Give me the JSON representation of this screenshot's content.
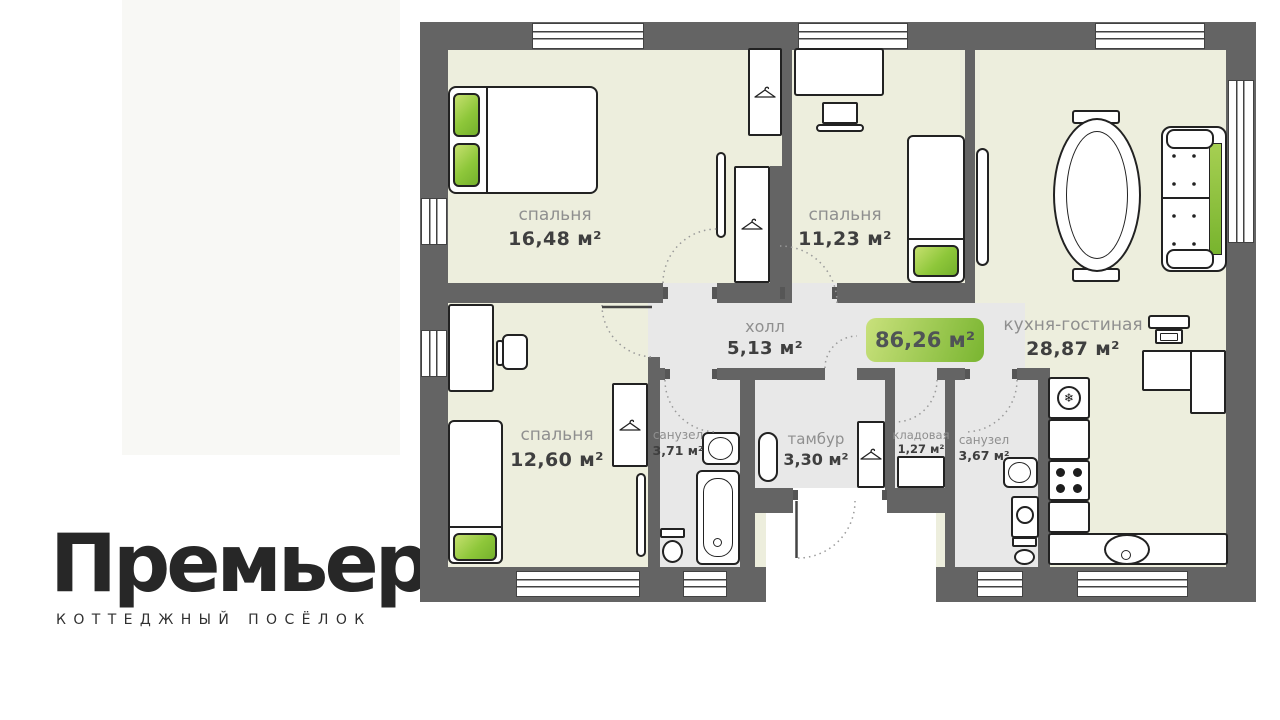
{
  "logo": {
    "title": "Премьер",
    "subtitle": "КОТТЕДЖНЫЙ ПОСЁЛОК"
  },
  "plan": {
    "total_area_badge": "86,26 м²",
    "rooms": {
      "bedroom_top_left": {
        "name": "спальня",
        "area": "16,48 м²"
      },
      "bedroom_top_middle": {
        "name": "спальня",
        "area": "11,23 м²"
      },
      "bedroom_bottom_left": {
        "name": "спальня",
        "area": "12,60 м²"
      },
      "kitchen_living": {
        "name": "кухня-гостиная",
        "area": "28,87 м²"
      },
      "hall": {
        "name": "холл",
        "area": "5,13 м²"
      },
      "bathroom_left": {
        "name": "санузел",
        "area": "3,71 м²"
      },
      "vestibule": {
        "name": "тамбур",
        "area": "3,30 м²"
      },
      "storage": {
        "name": "кладовая",
        "area": "1,27 м²"
      },
      "bathroom_right": {
        "name": "санузел",
        "area": "3,67 м²"
      }
    },
    "colors": {
      "wall": "#646464",
      "room_floor": "#edeedd",
      "wet_floor": "#e8e8e8",
      "accent_green_light": "#c6e06f",
      "accent_green_dark": "#74b12c",
      "label_gray": "#8f8f8f",
      "label_dark": "#3f3f3f"
    }
  }
}
